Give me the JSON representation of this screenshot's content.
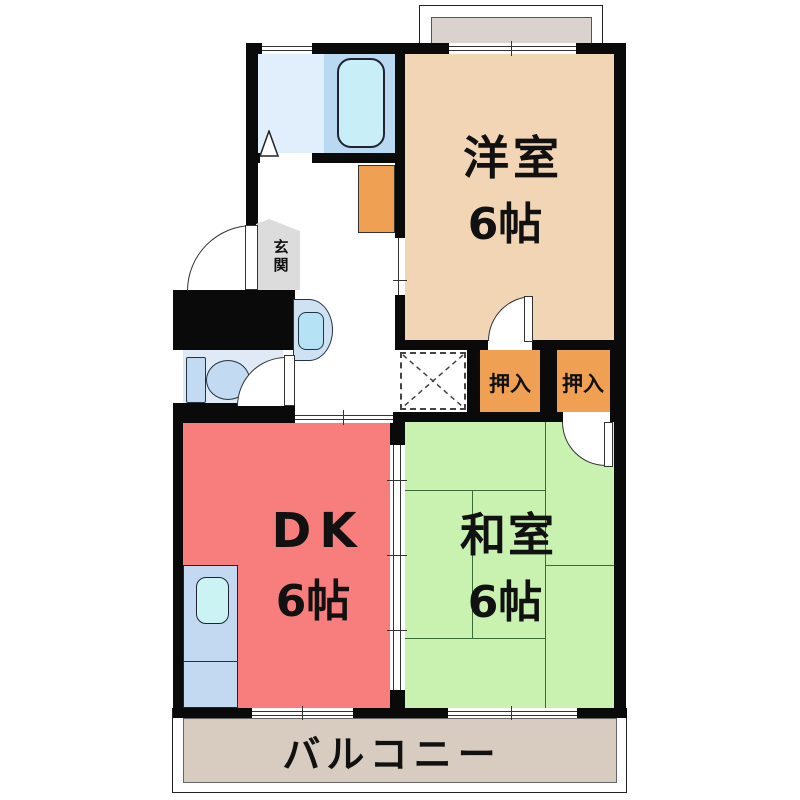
{
  "title": "2DK apartment floor plan",
  "rooms": {
    "western": {
      "name": "洋室",
      "size": "6帖"
    },
    "dk": {
      "name": "DK",
      "size": "6帖"
    },
    "japanese": {
      "name": "和室",
      "size": "6帖"
    },
    "closet1": {
      "name": "押入"
    },
    "closet2": {
      "name": "押入"
    },
    "entrance": {
      "name": "玄関"
    },
    "balcony": {
      "name": "バルコニー"
    }
  },
  "colors": {
    "wall": "#0a0a0a",
    "western-bg": "#f2d5b5",
    "dk-bg": "#f87e7e",
    "japanese-bg": "#c9f2b0",
    "closet-bg": "#f0a052",
    "washroom-bg": "#e0effb",
    "bath-bg": "#b9d9f2",
    "tub-bg": "#c8eff8",
    "toilet-bg": "#e0eaf6",
    "fixture-bg": "#c2daf2",
    "kitchen-bg": "#c3d9f2",
    "sink-bg": "#ccf3f3",
    "entrance-bg": "#dcdcdc",
    "balcony-bg": "#d8ccc1",
    "alcove-bg": "#d9d2ce",
    "tatami-line": "#3a6b35",
    "label": "#111111"
  }
}
